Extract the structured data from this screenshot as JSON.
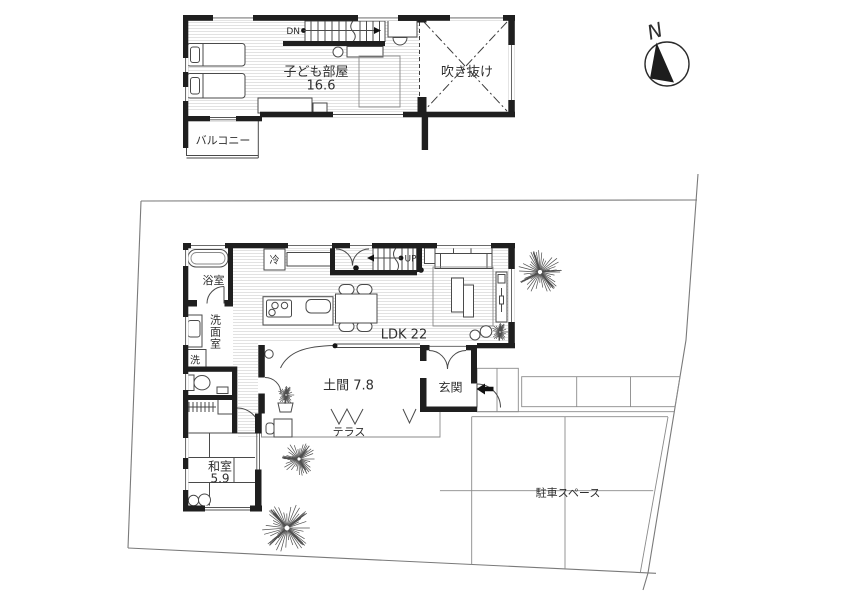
{
  "colors": {
    "wall": "#1f1f1f",
    "line": "#4a4a4a",
    "site_line": "#7a7a7a",
    "text": "#2f2f2f",
    "floor_hatch": "#e2e2e2",
    "entry_step": "#c4c4c4"
  },
  "compass": {
    "north": "N"
  },
  "floor2": {
    "kids_room": "子ども部屋",
    "kids_room_area": "16.6",
    "void": "吹き抜け",
    "balcony": "バルコニー",
    "stairs_down": "DN"
  },
  "floor1": {
    "ldk": "LDK 22",
    "doma": "土間 7.8",
    "terrace": "テラス",
    "entrance": "玄関",
    "bathroom": "浴室",
    "washroom": "洗面室",
    "laundry": "洗",
    "refrigerator": "冷",
    "stairs_up": "UP",
    "japanese_room": "和室",
    "japanese_room_area": "5.9"
  },
  "site": {
    "parking": "駐車スペース"
  }
}
